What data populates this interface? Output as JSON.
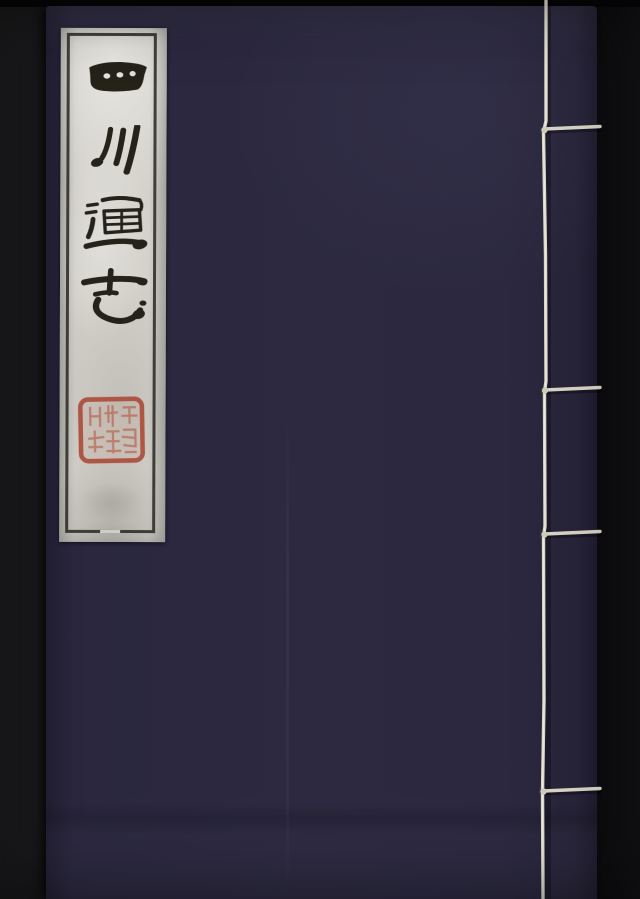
{
  "subject": {
    "kind": "Photograph of a traditional Chinese thread-bound book cover",
    "background_color": "#121214",
    "book": {
      "cover_color": "#2b2840",
      "title_label": {
        "title": "四川通志",
        "characters": [
          "四",
          "川",
          "通",
          "志"
        ],
        "writing_direction": "vertical, hand-brushed ink",
        "paper_color": "#d2d0c8",
        "frame_color": "#2c2b25",
        "ink_color": "#242219",
        "seal": {
          "shape": "square with rounded corners",
          "color": "#b0564a",
          "content": "illegible red seal script"
        }
      },
      "binding": {
        "type": "stab binding, white thread",
        "thread_color": "#d9d5c6",
        "visible_stitches": 4
      }
    }
  }
}
